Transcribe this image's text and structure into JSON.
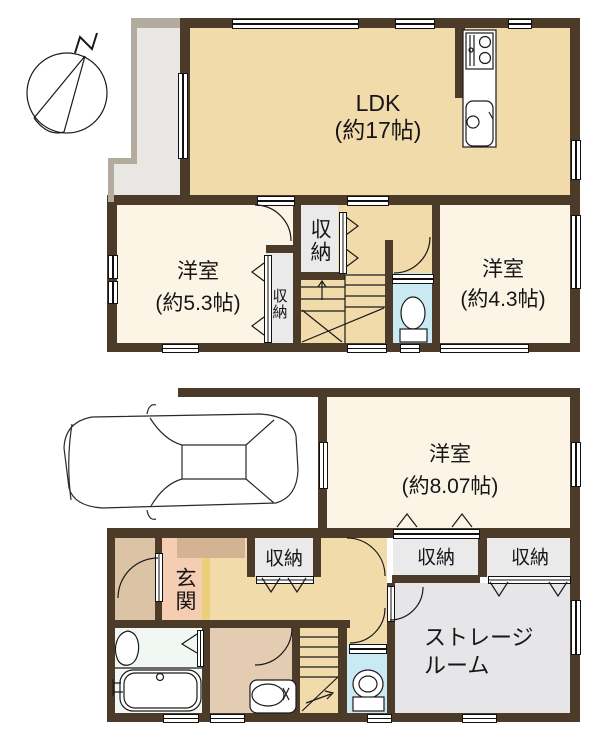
{
  "colors": {
    "wall": "#4C3B28",
    "balcony_wall": "#B3AB9E",
    "floor_tan": "#F1DBAB",
    "floor_cream": "#FCF4E4",
    "floor_gray": "#EAEAEA",
    "floor_blue": "#C9E9F3",
    "floor_bath": "#F1F8F3",
    "floor_pink": "#F5CDB3",
    "floor_porch": "#DCC3A6",
    "floor_step": "#EBCF79",
    "floor_storage": "#E6E6E8",
    "floor_cabinet": "#D3B391",
    "floor_balcony": "#E8E7E4"
  },
  "compass": {
    "label": "N"
  },
  "floor2": {
    "ldk": {
      "name": "LDK",
      "size": "(約17帖)"
    },
    "room_53": {
      "name": "洋室",
      "size": "(約5.3帖)"
    },
    "room_43": {
      "name": "洋室",
      "size": "(約4.3帖)"
    },
    "closet_hall": "収納",
    "closet_room": "収納"
  },
  "floor1": {
    "room_807": {
      "name": "洋室",
      "size": "(約8.07帖)"
    },
    "entrance": "玄関",
    "storage_room": {
      "line1": "ストレージ",
      "line2": "ルーム"
    },
    "closet_hall": "収納",
    "closet_a": "収納",
    "closet_b": "収納"
  }
}
